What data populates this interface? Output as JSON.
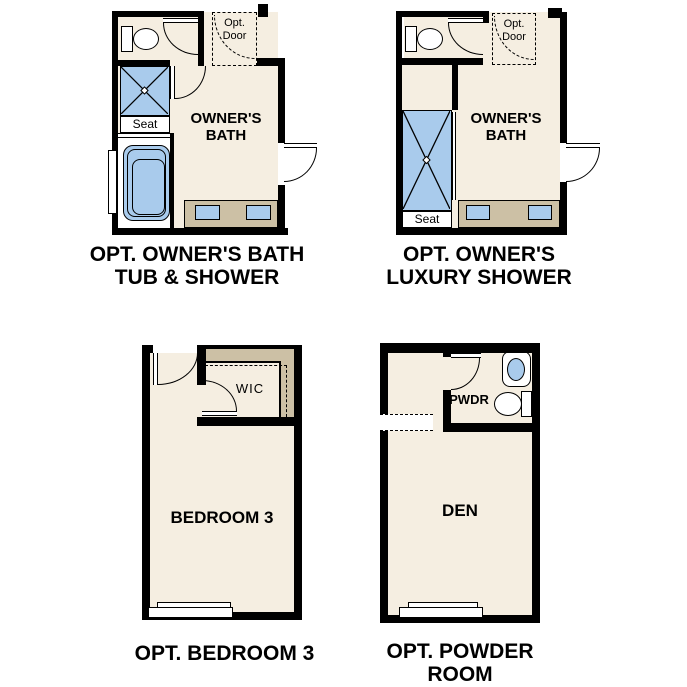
{
  "colors": {
    "wall_black": "#000000",
    "room_cream": "#f5eee1",
    "counter_tan": "#ccc0a5",
    "fixture_blue": "#a9cbec",
    "page_background": "#ffffff",
    "label_text": "#000000"
  },
  "plans": {
    "owners_bath_tub_shower": {
      "caption_line1": "OPT. OWNER'S BATH",
      "caption_line2": "TUB & SHOWER",
      "room_label_line1": "OWNER'S",
      "room_label_line2": "BATH",
      "seat_label": "Seat",
      "opt_door_line1": "Opt.",
      "opt_door_line2": "Door"
    },
    "owners_luxury_shower": {
      "caption_line1": "OPT. OWNER'S",
      "caption_line2": "LUXURY SHOWER",
      "room_label_line1": "OWNER'S",
      "room_label_line2": "BATH",
      "seat_label": "Seat",
      "opt_door_line1": "Opt.",
      "opt_door_line2": "Door"
    },
    "bedroom3": {
      "caption": "OPT. BEDROOM 3",
      "room_label": "BEDROOM 3",
      "wic_label": "WIC"
    },
    "powder_room": {
      "caption_line1": "OPT. POWDER",
      "caption_line2": "ROOM",
      "room_label": "DEN",
      "pwdr_label": "PWDR"
    }
  }
}
